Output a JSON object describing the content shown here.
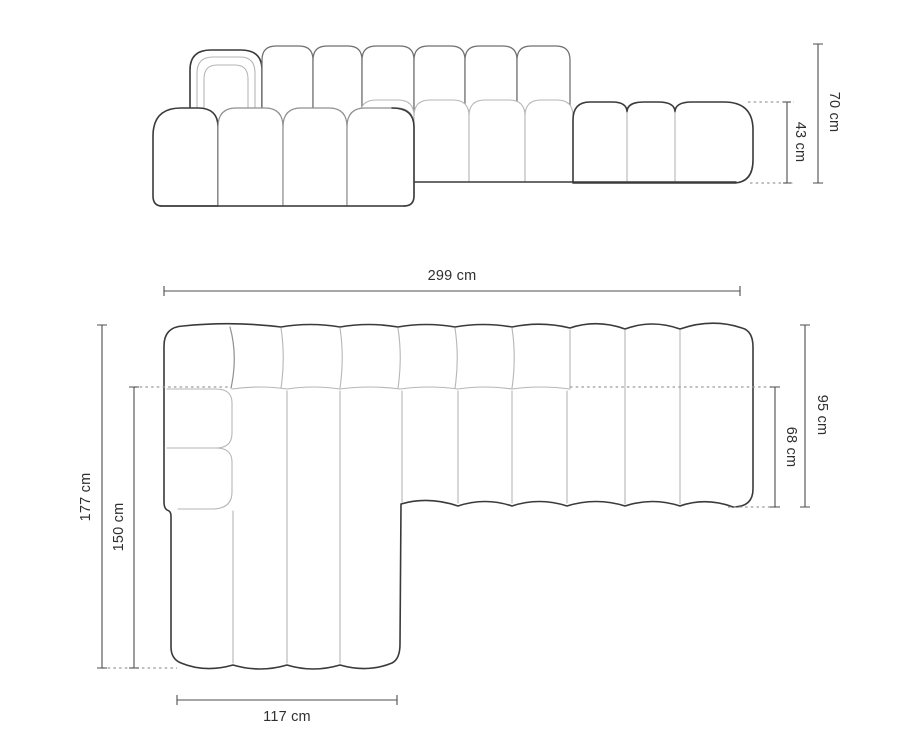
{
  "diagram": {
    "type": "sofa-dimension-drawing",
    "front_view": {
      "total_height": "70 cm",
      "seat_section_height": "43 cm"
    },
    "top_view": {
      "total_width": "299 cm",
      "total_depth": "95 cm",
      "seat_depth": "68 cm",
      "chaise_total_length": "177 cm",
      "chaise_inner_length": "150 cm",
      "chaise_width": "117 cm"
    },
    "colors": {
      "outline": "#3a3a3a",
      "channel_line": "#b6b6b6",
      "dimension_line": "#4d4d4d",
      "dotted_line": "#9a9a9a",
      "label_text": "#2f2f2f",
      "background": "#ffffff"
    }
  }
}
